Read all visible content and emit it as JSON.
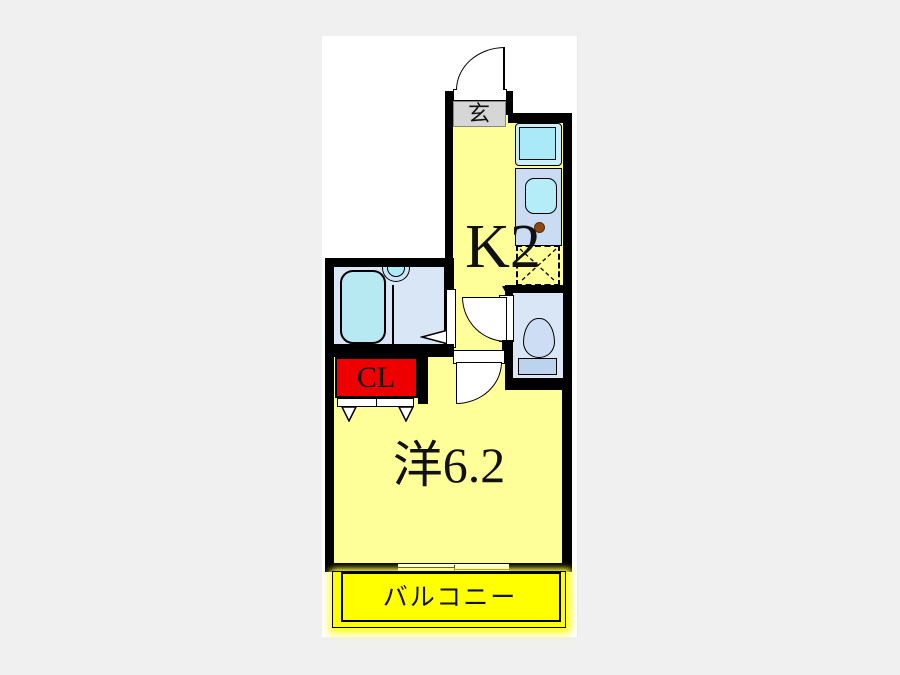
{
  "page": {
    "background": "#f0f0f0",
    "canvas_background": "#ffffff"
  },
  "floorplan": {
    "labels": {
      "entrance": "玄",
      "kitchen": "K2",
      "closet": "CL",
      "room": "洋6.2",
      "balcony": "バルコニー"
    },
    "colors": {
      "wall_black": "#000000",
      "floor_yellow": "#ffff99",
      "balcony_yellow": "#ffff00",
      "closet_red": "#ee0000",
      "entrance_gray": "#d6d6d6",
      "wet_area_blue": "#d9e6f6",
      "fixture_light_blue": "#c9dcf4",
      "basin_cyan": "#aeeaf8",
      "tub_cyan": "#b7e9f3",
      "valve_brown": "#8a4a16"
    }
  }
}
